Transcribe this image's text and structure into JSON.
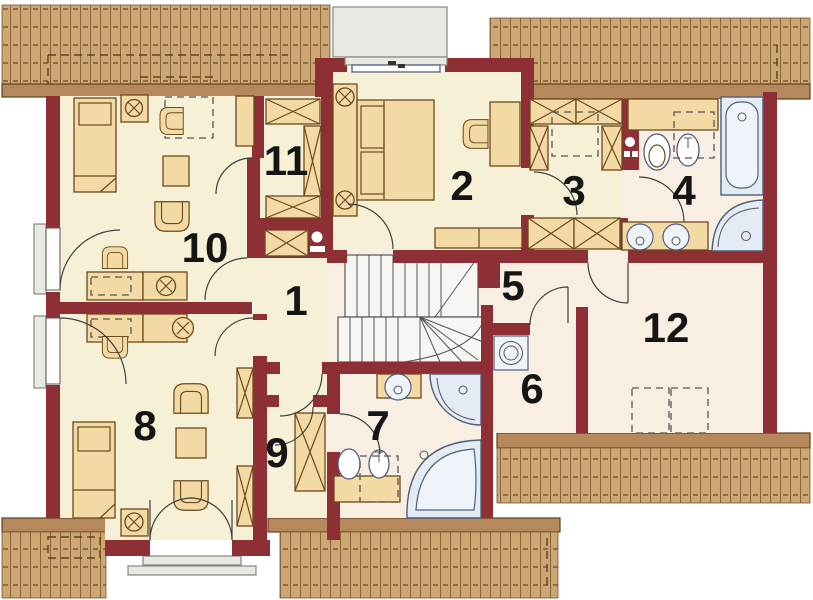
{
  "plan": {
    "width": 813,
    "height": 600
  },
  "rooms": {
    "r1": {
      "label": "1"
    },
    "r2": {
      "label": "2"
    },
    "r3": {
      "label": "3"
    },
    "r4": {
      "label": "4"
    },
    "r5": {
      "label": "5"
    },
    "r6": {
      "label": "6"
    },
    "r7": {
      "label": "7"
    },
    "r8": {
      "label": "8"
    },
    "r9": {
      "label": "9"
    },
    "r10": {
      "label": "10"
    },
    "r11": {
      "label": "11"
    },
    "r12": {
      "label": "12"
    }
  },
  "colors": {
    "wall": "#8e2f36",
    "floor-cream": "#f6f0d6",
    "floor-light": "#f8eee1",
    "furniture": "#f3d9a3",
    "furniture-stroke": "#6b4a1e",
    "roof-base": "#cfa672",
    "roof-line": "#6f5531",
    "eave": "#b6895c",
    "eave-stroke": "#5b431f",
    "fixture": "#e3ebf4",
    "fixture-light": "#eff4fa",
    "fixture-stroke": "#4f5f7d",
    "stair-fill": "#f7f6f2",
    "terrace": "#e9e9e4",
    "label": "#151515",
    "background": "#ffffff"
  }
}
